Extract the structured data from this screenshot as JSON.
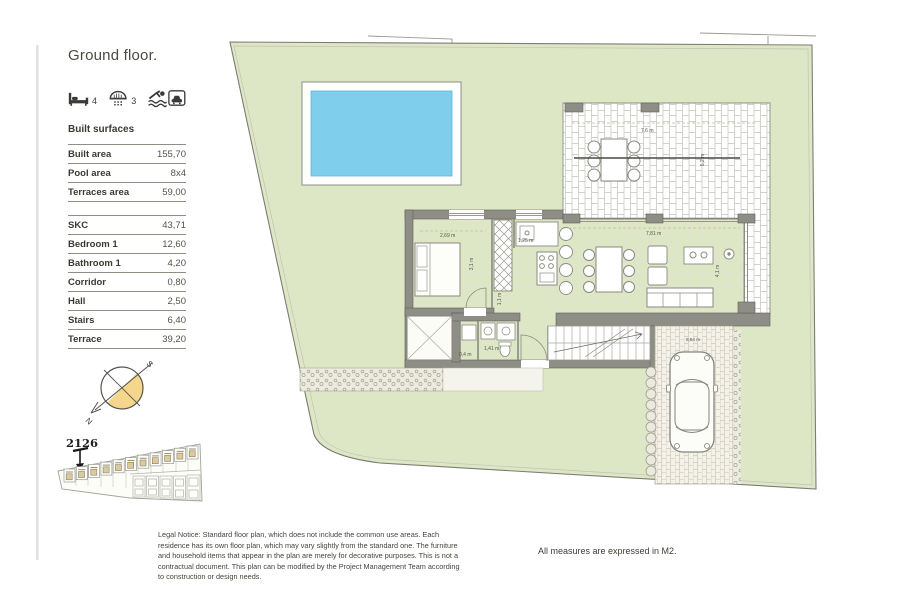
{
  "title": "Ground floor.",
  "features": {
    "beds_count": "4",
    "baths_count": "3"
  },
  "surfaces": {
    "heading": "Built surfaces",
    "summary": [
      {
        "label": "Built area",
        "value": "155,70"
      },
      {
        "label": "Pool area",
        "value": "8x4"
      },
      {
        "label": "Terraces area",
        "value": "59,00"
      }
    ],
    "rooms": [
      {
        "label": "SKC",
        "value": "43,71"
      },
      {
        "label": "Bedroom 1",
        "value": "12,60"
      },
      {
        "label": "Bathroom 1",
        "value": "4,20"
      },
      {
        "label": "Corridor",
        "value": "0,80"
      },
      {
        "label": "Hall",
        "value": "2,50"
      },
      {
        "label": "Stairs",
        "value": "6,40"
      },
      {
        "label": "Terrace",
        "value": "39,20"
      }
    ]
  },
  "compass": {
    "north": "N",
    "south": "S"
  },
  "siteplan": {
    "plot_number": "2126"
  },
  "plan": {
    "dims": {
      "bedroom_w": "2,69 m",
      "closet_w": "1,25 m",
      "bedroom_h": "3,1 m",
      "corridor_w": "1,1 m",
      "bath_w": "1,41 m",
      "utility_w": "0,4 m",
      "living_w": "7,81 m",
      "living_h": "4,1 m",
      "terrace_w": "7,6 m",
      "terrace_h": "5,2 m",
      "driveway_w": "8,54 m"
    }
  },
  "footer": {
    "legal_notice": "Legal Notice: Standard floor plan, which does not include the common use areas. Each residence has its own floor plan, which may vary slightly from the standard one. The furniture and household items that appear in the plan are merely for decorative purposes. This is not a contractual document. This plan can be modified by the Project Management Team according to construction or design needs.",
    "measures_note": "All measures are expressed in M2."
  },
  "colors": {
    "lawn": "#dde7c5",
    "pool": "#7fceec",
    "compass": "#f4d78c",
    "wall": "#8e8e86"
  }
}
